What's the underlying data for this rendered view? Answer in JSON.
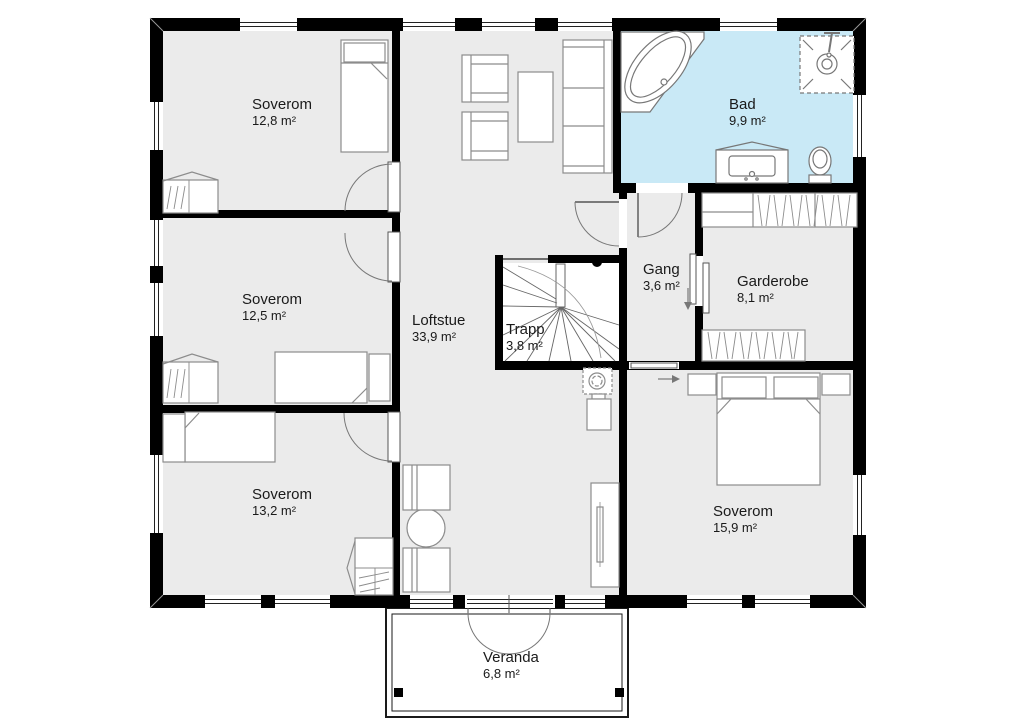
{
  "title": "Floor plan – loft storey",
  "colors": {
    "wall": "#000000",
    "room_floor": "#ebebeb",
    "bathroom_floor": "#c9e9f6",
    "stair_floor": "#ffffff",
    "furniture_line": "#8c8c8c"
  },
  "rooms": {
    "soverom_nw": {
      "name": "Soverom",
      "area": "12,8 m²"
    },
    "soverom_w": {
      "name": "Soverom",
      "area": "12,5 m²"
    },
    "soverom_sw": {
      "name": "Soverom",
      "area": "13,2 m²"
    },
    "loftstue": {
      "name": "Loftstue",
      "area": "33,9 m²"
    },
    "trapp": {
      "name": "Trapp",
      "area": "3,8 m²"
    },
    "bad": {
      "name": "Bad",
      "area": "9,9 m²"
    },
    "gang": {
      "name": "Gang",
      "area": "3,6 m²"
    },
    "garderobe": {
      "name": "Garderobe",
      "area": "8,1 m²"
    },
    "soverom_se": {
      "name": "Soverom",
      "area": "15,9 m²"
    },
    "veranda": {
      "name": "Veranda",
      "area": "6,8 m²"
    }
  }
}
